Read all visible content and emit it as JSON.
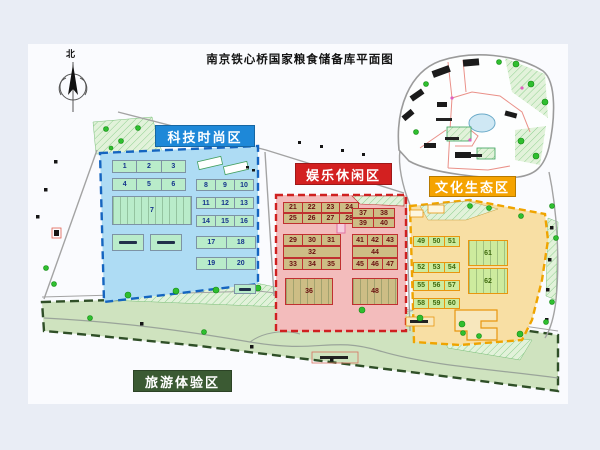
{
  "title": "南京铁心桥国家粮食储备库平面图",
  "compass": {
    "north": "北"
  },
  "zones": {
    "tech": {
      "label": "科技时尚区",
      "color": "#1e88d8",
      "fill": "#aedcf4",
      "border": "#1565c0"
    },
    "fun": {
      "label": "娱乐休闲区",
      "color": "#d32020",
      "fill": "#f3bcbc",
      "border": "#cf2020"
    },
    "culture": {
      "label": "文化生态区",
      "color": "#f5a300",
      "fill": "#f8dfa4",
      "border": "#efa400"
    },
    "tour": {
      "label": "旅游体验区",
      "color": "#3b5a33",
      "fill": "#cfe2c0",
      "border": "#2f4f27"
    }
  },
  "buildings": {
    "tech": [
      {
        "x": 112,
        "y": 160,
        "w": 74,
        "h": 13,
        "cells": [
          "1",
          "2",
          "3"
        ]
      },
      {
        "x": 112,
        "y": 178,
        "w": 74,
        "h": 13,
        "cells": [
          "4",
          "5",
          "6"
        ]
      },
      {
        "x": 112,
        "y": 196,
        "w": 80,
        "h": 29,
        "cells": [
          "7"
        ],
        "striped": true
      },
      {
        "x": 196,
        "y": 179,
        "w": 58,
        "h": 12,
        "cells": [
          "8",
          "9",
          "10"
        ]
      },
      {
        "x": 196,
        "y": 197,
        "w": 58,
        "h": 12,
        "cells": [
          "11",
          "12",
          "13"
        ]
      },
      {
        "x": 196,
        "y": 215,
        "w": 58,
        "h": 12,
        "cells": [
          "14",
          "15",
          "16"
        ]
      },
      {
        "x": 112,
        "y": 234,
        "w": 32,
        "h": 17,
        "cells": [
          ""
        ],
        "mark": true
      },
      {
        "x": 150,
        "y": 234,
        "w": 32,
        "h": 17,
        "cells": [
          ""
        ],
        "mark": true
      },
      {
        "x": 196,
        "y": 236,
        "w": 60,
        "h": 13,
        "cells": [
          "17",
          "18"
        ]
      },
      {
        "x": 196,
        "y": 257,
        "w": 60,
        "h": 13,
        "cells": [
          "19",
          "20"
        ]
      },
      {
        "x": 234,
        "y": 284,
        "w": 22,
        "h": 10,
        "cells": [
          ""
        ],
        "mark": true
      }
    ],
    "fun": [
      {
        "x": 283,
        "y": 202,
        "w": 76,
        "h": 11,
        "cells": [
          "21",
          "22",
          "23",
          "24"
        ]
      },
      {
        "x": 283,
        "y": 213,
        "w": 76,
        "h": 11,
        "cells": [
          "25",
          "26",
          "27",
          "28"
        ]
      },
      {
        "x": 352,
        "y": 208,
        "w": 43,
        "h": 10,
        "cells": [
          "37",
          "38"
        ]
      },
      {
        "x": 352,
        "y": 218,
        "w": 43,
        "h": 10,
        "cells": [
          "39",
          "40"
        ]
      },
      {
        "x": 283,
        "y": 234,
        "w": 58,
        "h": 12,
        "cells": [
          "29",
          "30",
          "31"
        ]
      },
      {
        "x": 283,
        "y": 246,
        "w": 58,
        "h": 12,
        "cells": [
          "32"
        ]
      },
      {
        "x": 283,
        "y": 258,
        "w": 58,
        "h": 12,
        "cells": [
          "33",
          "34",
          "35"
        ]
      },
      {
        "x": 352,
        "y": 234,
        "w": 46,
        "h": 12,
        "cells": [
          "41",
          "42",
          "43"
        ]
      },
      {
        "x": 352,
        "y": 246,
        "w": 46,
        "h": 12,
        "cells": [
          "44"
        ]
      },
      {
        "x": 352,
        "y": 258,
        "w": 46,
        "h": 12,
        "cells": [
          "45",
          "46",
          "47"
        ]
      },
      {
        "x": 285,
        "y": 278,
        "w": 48,
        "h": 27,
        "cells": [
          "36"
        ],
        "striped": true
      },
      {
        "x": 352,
        "y": 278,
        "w": 46,
        "h": 27,
        "cells": [
          "48"
        ],
        "striped": true
      }
    ],
    "culture": [
      {
        "x": 413,
        "y": 236,
        "w": 47,
        "h": 11,
        "cells": [
          "49",
          "50",
          "51"
        ]
      },
      {
        "x": 413,
        "y": 262,
        "w": 47,
        "h": 11,
        "cells": [
          "52",
          "53",
          "54"
        ]
      },
      {
        "x": 413,
        "y": 280,
        "w": 47,
        "h": 11,
        "cells": [
          "55",
          "56",
          "57"
        ]
      },
      {
        "x": 413,
        "y": 298,
        "w": 47,
        "h": 11,
        "cells": [
          "58",
          "59",
          "60"
        ]
      },
      {
        "x": 468,
        "y": 240,
        "w": 40,
        "h": 26,
        "cells": [
          "61"
        ],
        "striped": true
      },
      {
        "x": 468,
        "y": 268,
        "w": 40,
        "h": 26,
        "cells": [
          "62"
        ],
        "striped": true
      }
    ]
  }
}
